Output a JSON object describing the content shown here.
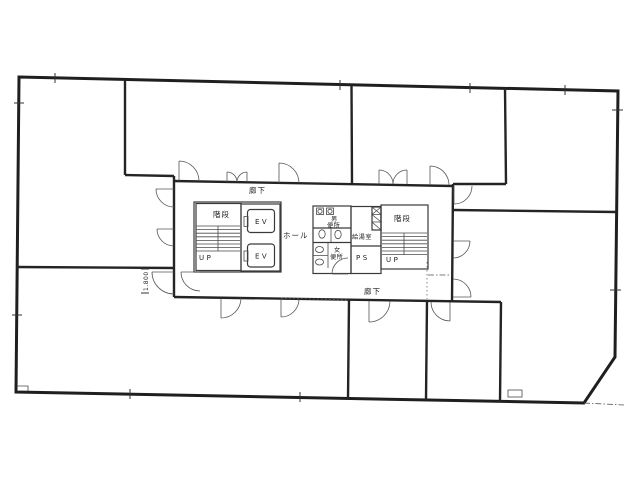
{
  "plan": {
    "corridors": {
      "top": "廊下",
      "bottom": "廊下"
    },
    "hall": "ホール",
    "stairwells": {
      "left": {
        "name": "階段",
        "direction": "UP"
      },
      "right": {
        "name": "階段",
        "direction": "UP"
      }
    },
    "elevators": {
      "ev1": "EV",
      "ev2": "EV"
    },
    "toilets": {
      "mens": {
        "line1": "男",
        "line2": "便所"
      },
      "womens": {
        "line1": "女",
        "line2": "便所"
      }
    },
    "kitchenette": "給湯室",
    "pipe_space": "PS",
    "dimension_label": "1.800"
  },
  "colors": {
    "paper": "#ffffff",
    "ink": "#222222"
  }
}
